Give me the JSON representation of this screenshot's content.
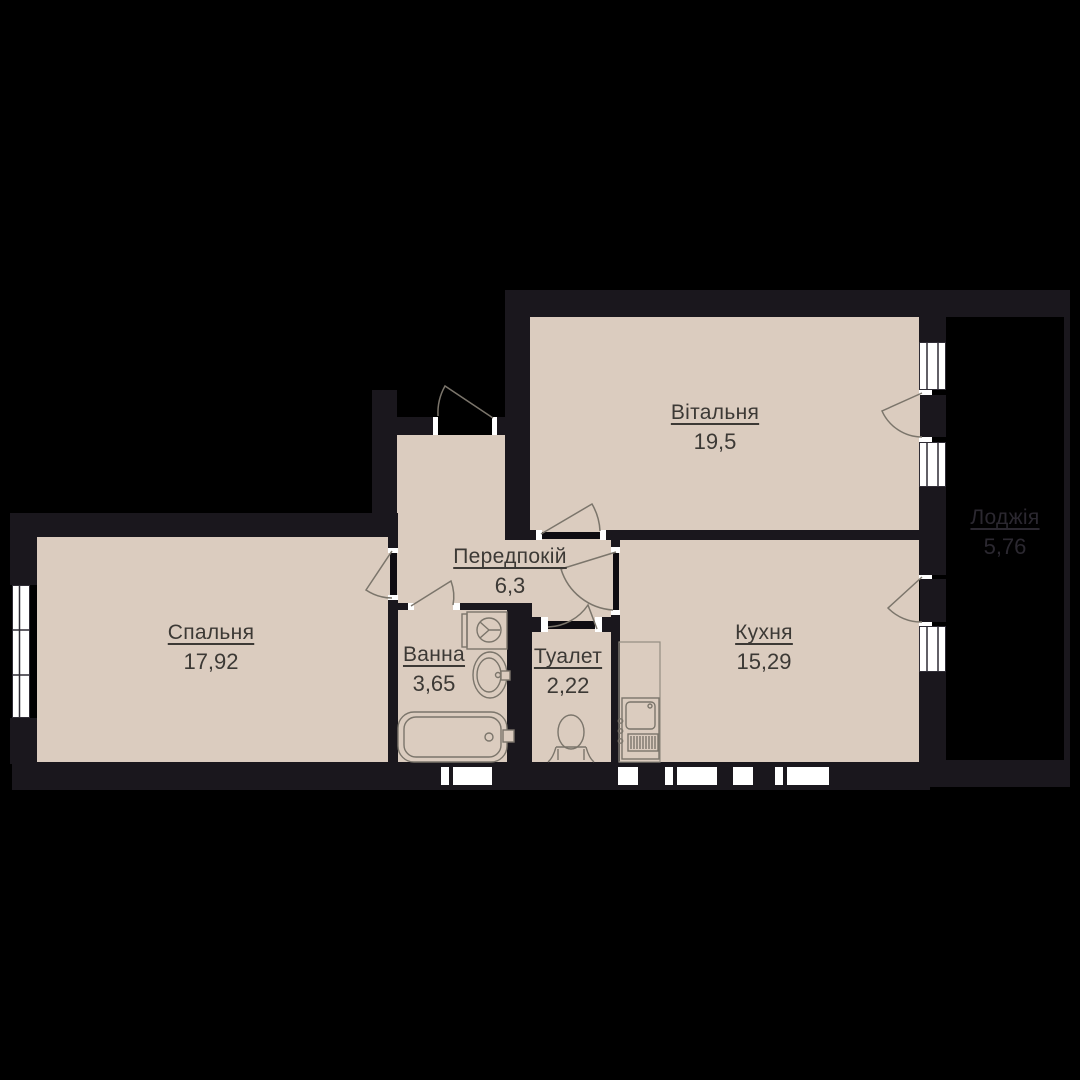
{
  "plan": {
    "type": "apartment-floor-plan",
    "rooms": [
      {
        "id": "living",
        "name": "Вітальня",
        "area": "19,5"
      },
      {
        "id": "bedroom",
        "name": "Спальня",
        "area": "17,92"
      },
      {
        "id": "hallway",
        "name": "Передпокій",
        "area": "6,3"
      },
      {
        "id": "bathroom",
        "name": "Ванна",
        "area": "3,65"
      },
      {
        "id": "toilet",
        "name": "Туалет",
        "area": "2,22"
      },
      {
        "id": "kitchen",
        "name": "Кухня",
        "area": "15,29"
      },
      {
        "id": "loggia",
        "name": "Лоджія",
        "area": "5,76"
      }
    ],
    "colors": {
      "background": "#000000",
      "wall": "#1a171d",
      "floor": "#dbccbf",
      "door_leaf": "#0e0c11",
      "fixture_line": "#7b756b",
      "window_frame": "#2f2c35",
      "label_text": "#3c3935",
      "loggia_label_text": "#2b2830",
      "opening_white": "#ffffff"
    }
  }
}
